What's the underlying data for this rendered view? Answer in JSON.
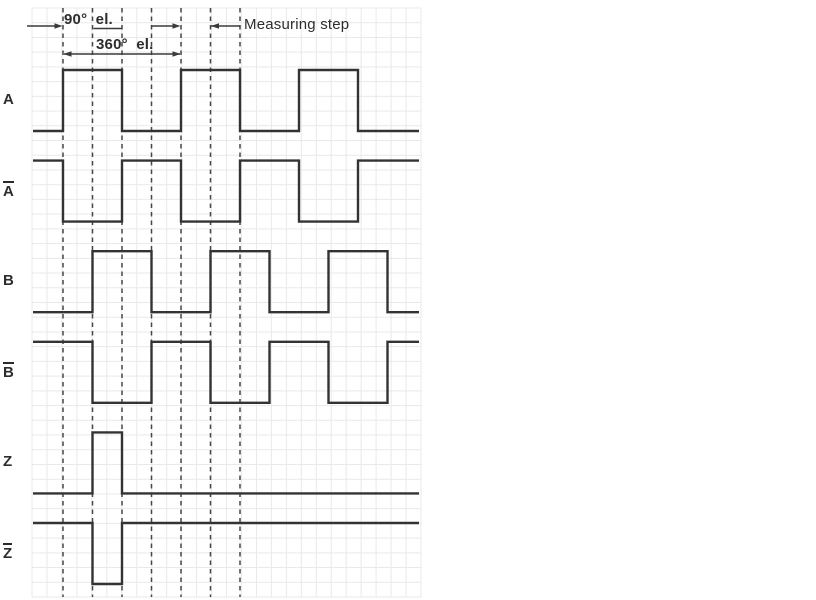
{
  "page": {
    "background": "#ffffff"
  },
  "colors": {
    "grid_line": "#e9e9ec",
    "signal_line": "#333333",
    "marker_line": "#474747",
    "dimension_line": "#3a3a3a",
    "text": "#2d2d2d"
  },
  "annotations": {
    "dim_90_label": "90° el.",
    "dim_360_label": "360° el.",
    "measuring_step_label": "Measuring step"
  },
  "chart_data": {
    "type": "line",
    "subtype": "digital-timing-diagram",
    "x_unit": "degrees electrical",
    "x_range_deg": [
      -90,
      1085
    ],
    "grid": "on",
    "legend": "none",
    "marker_lines_deg": [
      0,
      90,
      180,
      270,
      360,
      450,
      540
    ],
    "dimensions": [
      {
        "label": "90° el.",
        "from_deg": 0,
        "to_deg": 90
      },
      {
        "label": "360° el.",
        "from_deg": 0,
        "to_deg": 360
      },
      {
        "label": "Measuring step",
        "from_deg": 360,
        "to_deg": 450
      }
    ],
    "levels": {
      "high": 1,
      "low": 0
    },
    "signals": [
      {
        "label": "A",
        "overline": false,
        "initial_level": 0,
        "toggle_edges_deg": [
          0,
          180,
          360,
          540,
          720,
          900
        ]
      },
      {
        "label": "A",
        "overline": true,
        "initial_level": 1,
        "toggle_edges_deg": [
          0,
          180,
          360,
          540,
          720,
          900
        ]
      },
      {
        "label": "B",
        "overline": false,
        "initial_level": 0,
        "toggle_edges_deg": [
          90,
          270,
          450,
          630,
          810,
          990
        ]
      },
      {
        "label": "B",
        "overline": true,
        "initial_level": 1,
        "toggle_edges_deg": [
          90,
          270,
          450,
          630,
          810,
          990
        ]
      },
      {
        "label": "Z",
        "overline": false,
        "initial_level": 0,
        "toggle_edges_deg": [
          90,
          180
        ]
      },
      {
        "label": "Z",
        "overline": true,
        "initial_level": 1,
        "toggle_edges_deg": [
          90,
          180
        ]
      }
    ]
  }
}
